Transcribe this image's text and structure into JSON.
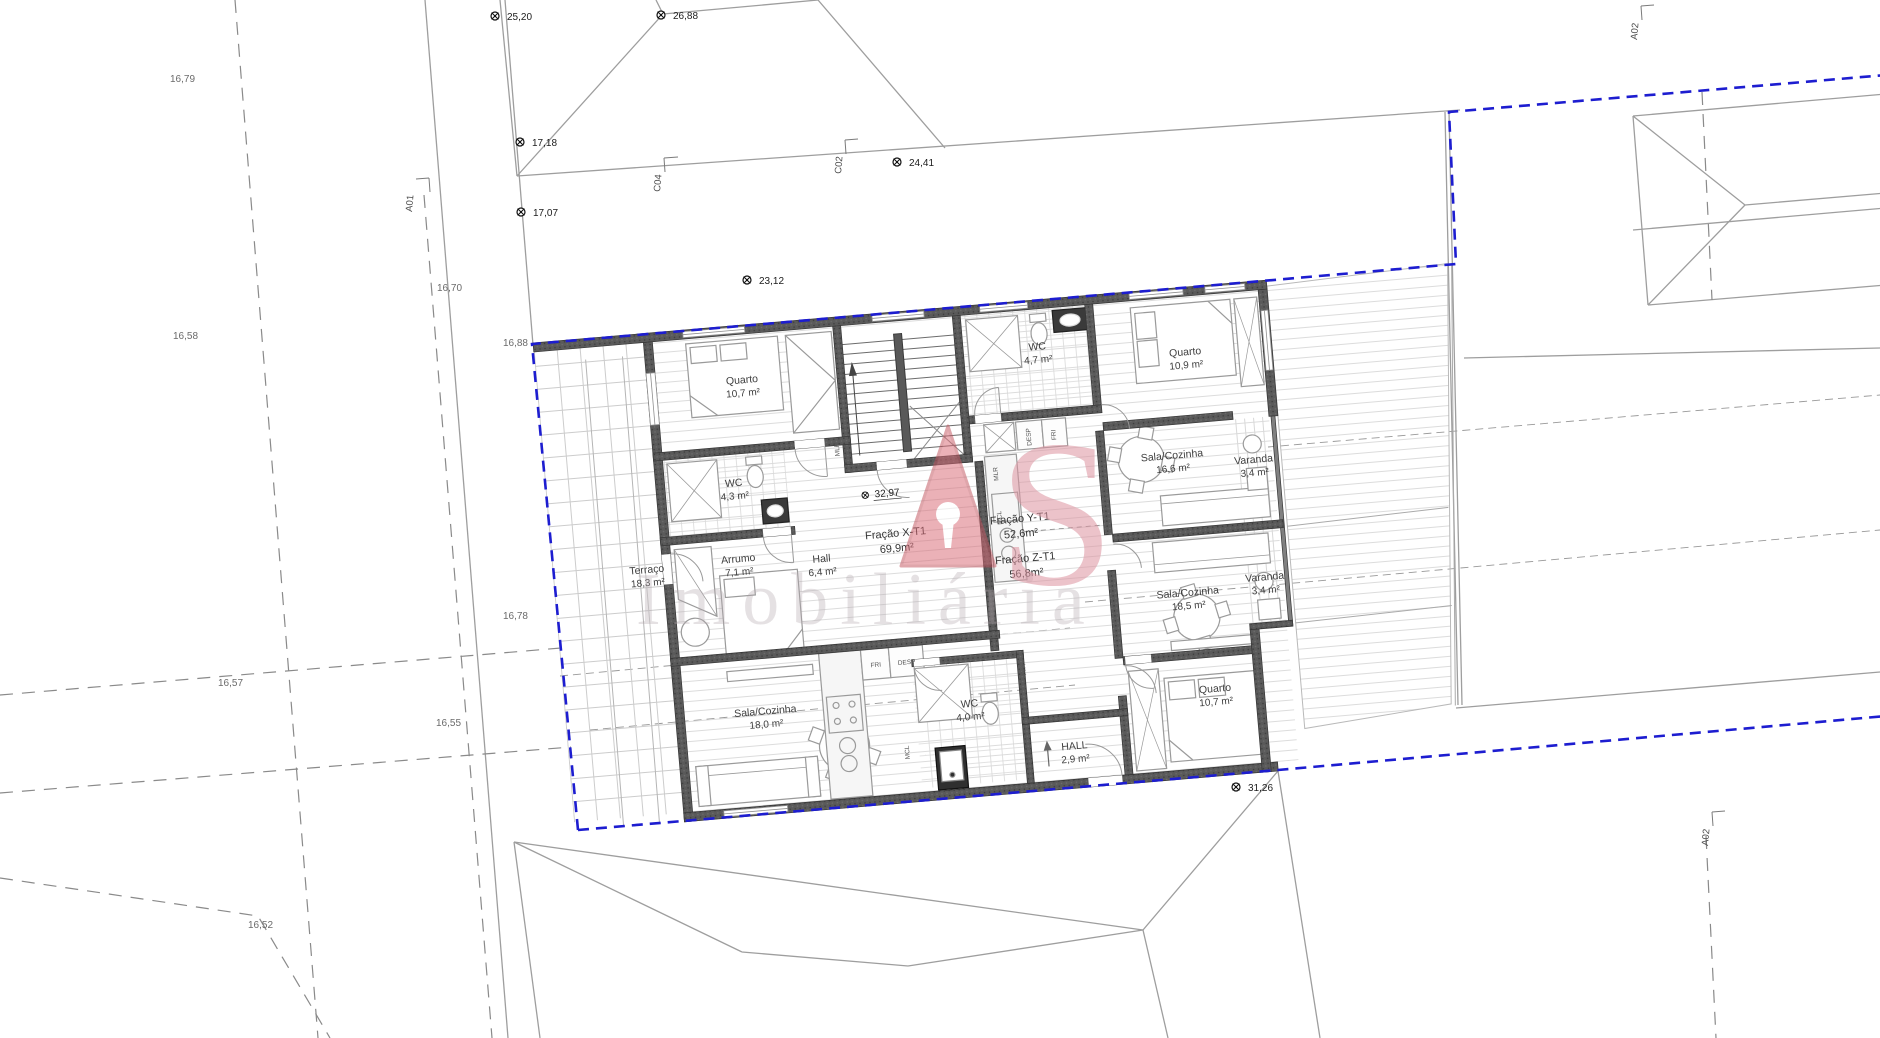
{
  "colors": {
    "boundary_blue": "#1d1dd0",
    "wall_gray": "#595959",
    "context_gray": "#9e9e9e",
    "watermark_red": "#d96a76",
    "watermark_pink": "#dd93a0"
  },
  "rooms": {
    "terraco": {
      "label": "Terraço",
      "area": "18,3 m²"
    },
    "quarto_x": {
      "label": "Quarto",
      "area": "10,7 m²"
    },
    "wc_x": {
      "label": "WC",
      "area": "4,3 m²"
    },
    "arrumo": {
      "label": "Arrumo",
      "area": "7,1 m²"
    },
    "hall_x": {
      "label": "Hall",
      "area": "6,4 m²"
    },
    "sala_x": {
      "label": "Sala/Cozinha",
      "area": "18,0 m²"
    },
    "wc_y": {
      "label": "WC",
      "area": "4,7 m²"
    },
    "quarto_y": {
      "label": "Quarto",
      "area": "10,9 m²"
    },
    "sala_y": {
      "label": "Sala/Cozinha",
      "area": "16,6 m²"
    },
    "varanda_y": {
      "label": "Varanda",
      "area": "3,4 m²"
    },
    "sala_z": {
      "label": "Sala/Cozinha",
      "area": "18,5 m²"
    },
    "varanda_z": {
      "label": "Varanda",
      "area": "3,4 m²"
    },
    "quarto_z": {
      "label": "Quarto",
      "area": "10,7 m²"
    },
    "wc_z": {
      "label": "WC",
      "area": "4,0 m²"
    },
    "hall_z": {
      "label": "HALL",
      "area": "2,9 m²"
    }
  },
  "fractions": {
    "x": {
      "label": "Fração X-T1",
      "area": "69,9m²"
    },
    "y": {
      "label": "Fração Y-T1",
      "area": "52,6m²"
    },
    "z": {
      "label": "Fração Z-T1",
      "area": "56,8m²"
    }
  },
  "markers": {
    "v2520": "25,20",
    "v2688": "26,88",
    "v1718": "17,18",
    "v1707": "17,07",
    "v2441": "24,41",
    "v2312": "23,12",
    "v3297": "32,97",
    "v3126": "31,26"
  },
  "elevations": {
    "e1679": "16,79",
    "e1658": "16,58",
    "e1670": "16,70",
    "e1688": "16,88",
    "e1678": "16,78",
    "e1657": "16,57",
    "e1655": "16,55",
    "e1652": "16,52"
  },
  "axes": {
    "a01": "A01",
    "a02": "A02",
    "c02": "C02",
    "c04": "C04"
  },
  "fixtures": {
    "mlr": "MLR",
    "desp": "DESP",
    "fri": "FRI",
    "mcl": "MCL",
    "tva": "TVA"
  },
  "watermark": {
    "s": "S",
    "word": "Imobiliária"
  }
}
